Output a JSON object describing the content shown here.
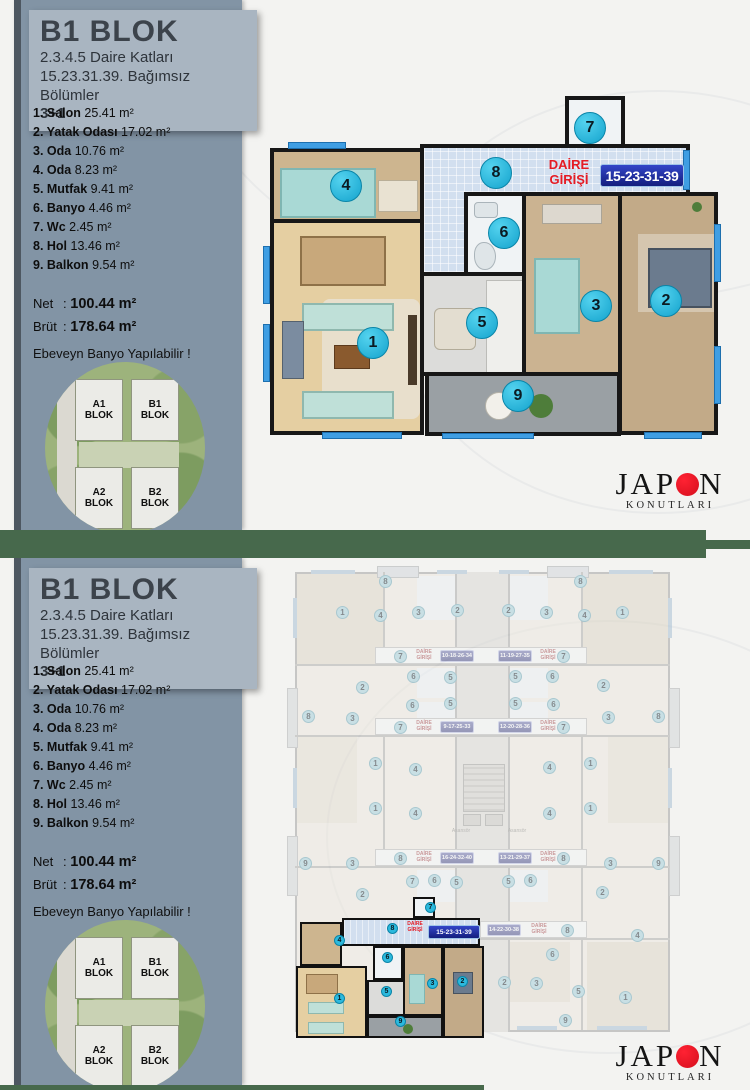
{
  "sidebar": {
    "title": "B1 BLOK",
    "subtitle1": "2.3.4.5 Daire Katları",
    "subtitle2": "15.23.31.39. Bağımsız Bölümler",
    "subtitle3": "3+1",
    "rooms": [
      {
        "label": "1. Salon",
        "area": "25.41 m²"
      },
      {
        "label": "2. Yatak Odası",
        "area": "17.02 m²"
      },
      {
        "label": "3. Oda",
        "area": "10.76 m²"
      },
      {
        "label": "4. Oda",
        "area": "8.23 m²"
      },
      {
        "label": "5. Mutfak",
        "area": "9.41 m²"
      },
      {
        "label": "6. Banyo",
        "area": "4.46 m²"
      },
      {
        "label": "7. Wc",
        "area": "2.45 m²"
      },
      {
        "label": "8. Hol",
        "area": "13.46 m²"
      },
      {
        "label": "9. Balkon",
        "area": "9.54 m²"
      }
    ],
    "net_label": "Net",
    "net_sep": ":",
    "net_value": "100.44 m²",
    "brut_label": "Brüt",
    "brut_sep": ":",
    "brut_value": "178.64 m²",
    "note": "Ebeveyn Banyo Yapılabilir !",
    "site_blocks": [
      {
        "label": "A1 BLOK"
      },
      {
        "label": "B1 BLOK"
      },
      {
        "label": "A2 BLOK"
      },
      {
        "label": "B2 BLOK"
      }
    ]
  },
  "plan": {
    "entry_line1": "DAİRE",
    "entry_line2": "GİRİŞİ",
    "unit_badge": "15-23-31-39",
    "circles": [
      "1",
      "2",
      "3",
      "4",
      "5",
      "6",
      "7",
      "8",
      "9"
    ]
  },
  "floor_plan": {
    "asansor": "Asansör",
    "entry_line1": "DAİRE",
    "entry_line2": "GİRİŞİ",
    "badges": {
      "r1l": "10-18-26-34",
      "r1r": "11-19-27-35",
      "r2l": "9-17-25-33",
      "r2r": "12-20-28-36",
      "r3l": "16-24-32-40",
      "r3r": "13-21-29-37",
      "r4l": "15-23-31-39",
      "r4r": "14-22-30-38"
    }
  },
  "logo": {
    "part1": "JAP",
    "part2": "N",
    "sub": "KONUTLARI"
  },
  "colors": {
    "accent_teal": "#2cb9dd",
    "badge_blue": "#1e2a9c",
    "entry_red": "#e51c24",
    "divider_green": "#47694c",
    "sidebar": "#8294a5",
    "header_box": "#a9b5c1",
    "logo_red": "#d50f1d"
  }
}
